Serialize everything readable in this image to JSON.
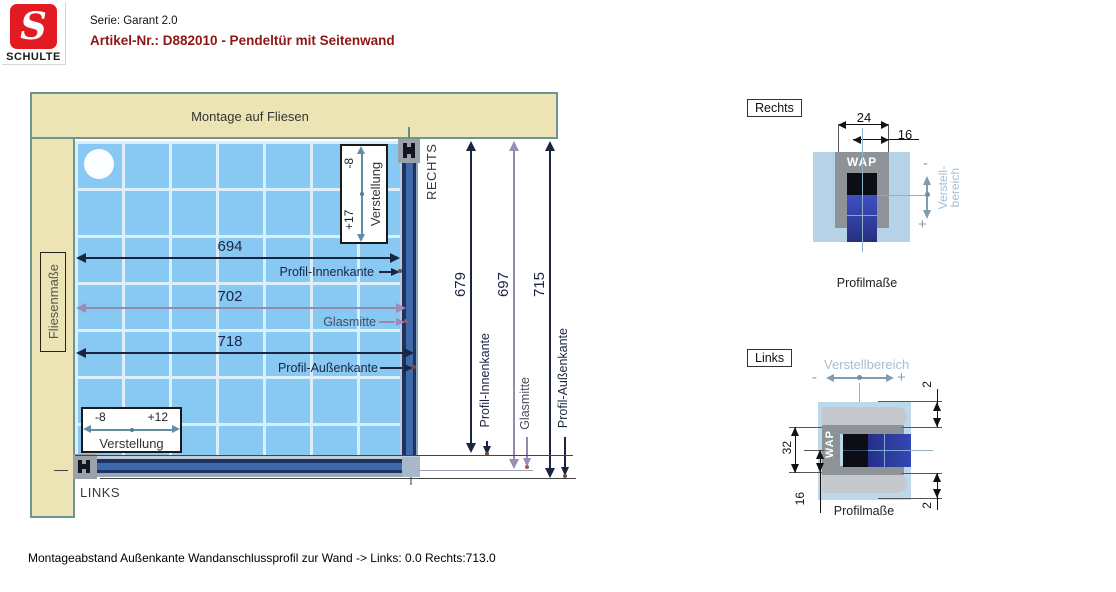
{
  "header": {
    "serie": "Serie: Garant 2.0",
    "artikel": "Artikel-Nr.: D882010 - Pendeltür mit Seitenwand"
  },
  "logo": {
    "s": "S",
    "name": "SCHULTE"
  },
  "main": {
    "wall_top_label": "Montage auf Fliesen",
    "wall_left_label": "Fliesenmaße",
    "side_right": "RECHTS",
    "side_left": "LINKS",
    "h_dims": [
      {
        "value": "694",
        "target": "Profil-Innenkante"
      },
      {
        "value": "702",
        "target": "Glasmitte"
      },
      {
        "value": "718",
        "target": "Profil-Außenkante"
      }
    ],
    "v_dims": [
      {
        "value": "679",
        "label": "Profil-Innenkante"
      },
      {
        "value": "697",
        "label": "Glasmitte"
      },
      {
        "value": "715",
        "label": "Profil-Außenkante"
      }
    ],
    "adjust_top": {
      "plus": "+17",
      "minus": "-8",
      "label": "Verstellung"
    },
    "adjust_bottom": {
      "minus": "-8",
      "plus": "+12",
      "label": "Verstellung"
    }
  },
  "details": {
    "rechts": {
      "title": "Rechts",
      "dim_width": "24",
      "dim_offset": "16",
      "wap": "WAP",
      "minus": "-",
      "plus": "+",
      "range_line1": "Verstell-",
      "range_line2": "bereich",
      "caption": "Profilmaße"
    },
    "links": {
      "title": "Links",
      "range_label": "Verstellbereich",
      "minus": "-",
      "plus": "+",
      "wap": "WAP",
      "dim_height": "32",
      "dim_half": "16",
      "dim_gap_top": "2",
      "dim_gap_bottom": "2",
      "caption": "Profilmaße"
    }
  },
  "footer": {
    "text": "Montageabstand Außenkante Wandanschlussprofil zur Wand -> Links: 0.0  Rechts:713.0"
  },
  "colors": {
    "wall_beige": "#ece4b4",
    "wall_border": "#6f9494",
    "tile_blue": "#87c9f3",
    "tile_grid": "#ddeefb",
    "profile_navy": "#1c3260",
    "profile_mid": "#3e6aab",
    "dim_dark": "#1b2440",
    "dim_mauve": "#9c8cb8",
    "adjust_teal": "#5f8fa0",
    "detail_wall": "#b5d2e6",
    "detail_gray": "#8e9398",
    "glass_blue": "#2c3a9a",
    "light_blue_text": "#a4bfd3",
    "brand_red": "#e21b22",
    "artikel_maroon": "#8c1713"
  }
}
